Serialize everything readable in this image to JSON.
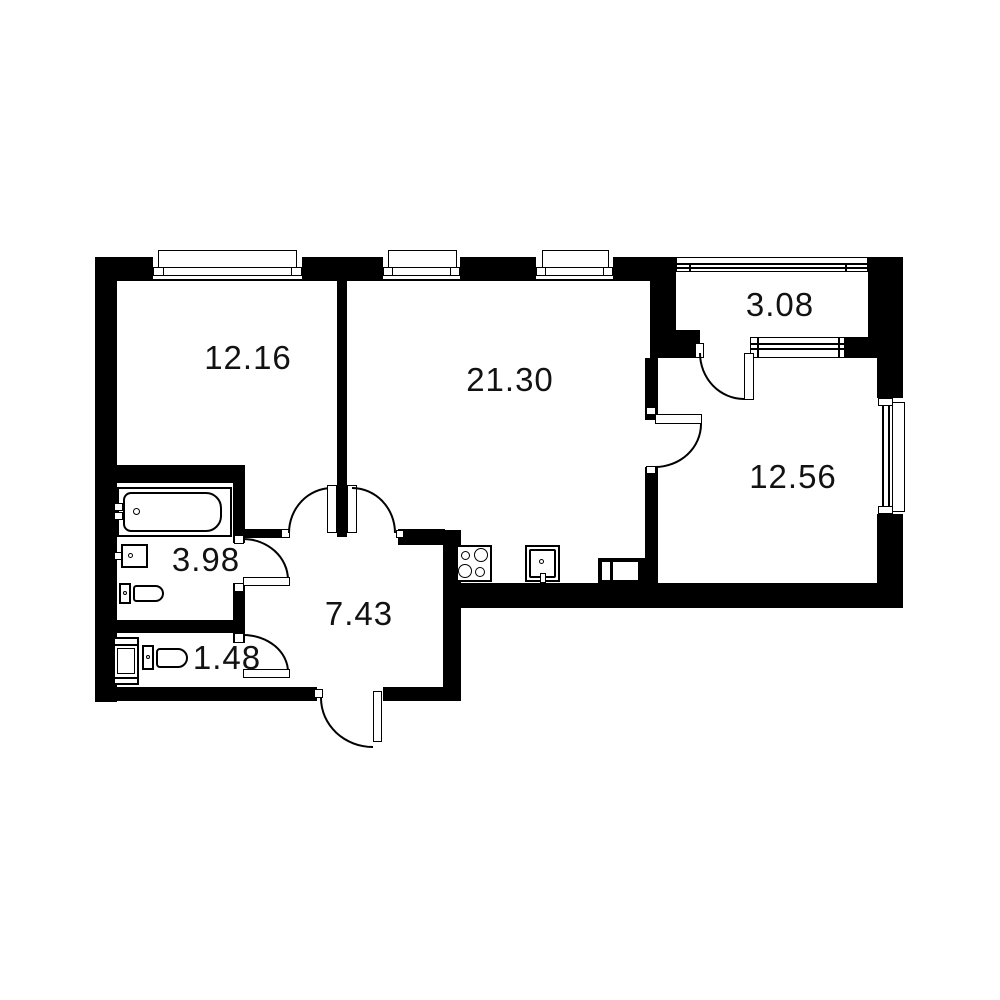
{
  "title": "Apartment floor plan",
  "colors": {
    "walls": "#000000",
    "background": "#ffffff",
    "text": "#121212"
  },
  "rooms": [
    {
      "name": "bedroom",
      "area": "12.16"
    },
    {
      "name": "living-kitchen",
      "area": "21.30"
    },
    {
      "name": "balcony",
      "area": "3.08"
    },
    {
      "name": "bedroom-2",
      "area": "12.56"
    },
    {
      "name": "bathroom",
      "area": "3.98"
    },
    {
      "name": "hallway",
      "area": "7.43"
    },
    {
      "name": "wc",
      "area": "1.48"
    }
  ],
  "fixtures": [
    "bathtub",
    "bathroom-sink",
    "bathroom-toilet",
    "washing-machine",
    "wc-toilet",
    "stove-4-burners",
    "kitchen-sink",
    "vent-duct"
  ],
  "openings": [
    "window-bedroom",
    "window-living-1",
    "window-living-2",
    "balcony-glazing",
    "balcony-window",
    "window-bedroom-2",
    "door-bedroom",
    "door-living",
    "door-bathroom",
    "door-wc",
    "door-bedroom-2",
    "door-balcony",
    "entrance-door"
  ]
}
